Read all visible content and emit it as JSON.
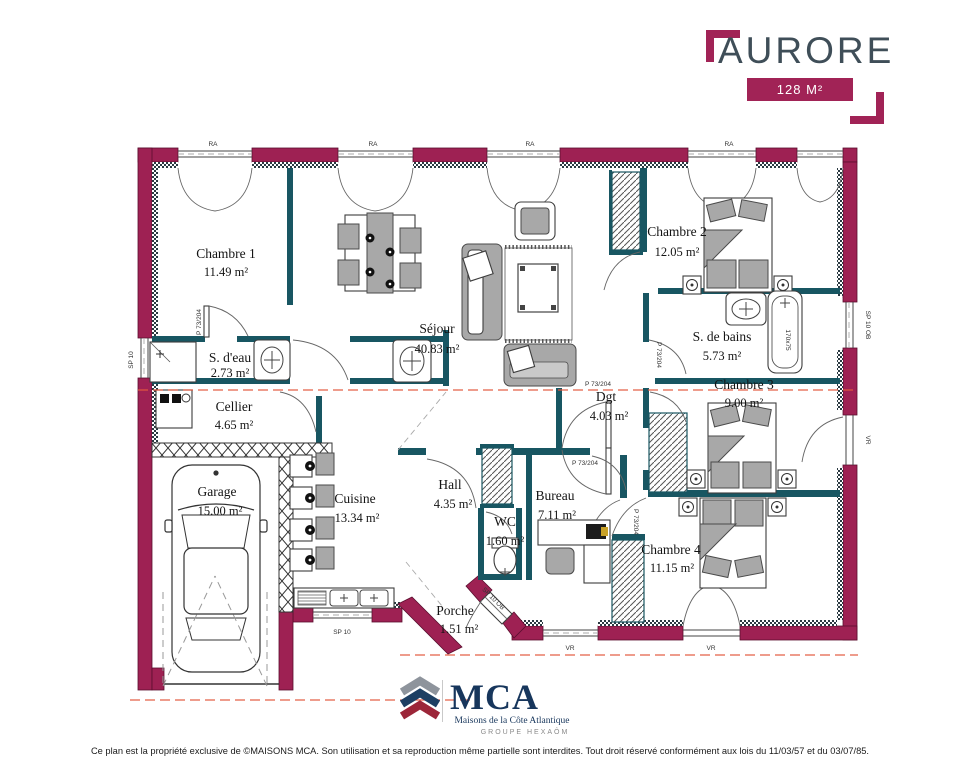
{
  "header": {
    "title": "AURORE",
    "area_badge": "128 M²"
  },
  "plan": {
    "rooms": [
      {
        "name": "Chambre 1",
        "area": "11.49 m²"
      },
      {
        "name": "Séjour",
        "area": "40.83 m²"
      },
      {
        "name": "Chambre 2",
        "area": "12.05 m²"
      },
      {
        "name": "S. de bains",
        "area": "5.73 m²"
      },
      {
        "name": "Chambre 3",
        "area": "9.00 m²"
      },
      {
        "name": "S. d'eau",
        "area": "2.73 m²"
      },
      {
        "name": "Cellier",
        "area": "4.65 m²"
      },
      {
        "name": "Dgt",
        "area": "4.03 m²"
      },
      {
        "name": "Garage",
        "area": "15.00 m²"
      },
      {
        "name": "Cuisine",
        "area": "13.34 m²"
      },
      {
        "name": "Hall",
        "area": "4.35 m²"
      },
      {
        "name": "WC",
        "area": "1.60 m²"
      },
      {
        "name": "Bureau",
        "area": "7.11 m²"
      },
      {
        "name": "Chambre 4",
        "area": "11.15 m²"
      },
      {
        "name": "Porche",
        "area": "1.51 m²"
      }
    ],
    "annotations": {
      "window_top": "RA",
      "shutter": "VR",
      "window_small": "SP 10",
      "entry_window": "SP 10 OB",
      "door": "P 73/204",
      "bath": "170x75"
    },
    "colors": {
      "wall_exterior": "#9e2153",
      "wall_interior": "#185662",
      "accent": "#a12356",
      "title": "#3f4e58",
      "section_line": "#e4573d"
    }
  },
  "footer": {
    "logo": "MCA",
    "subtitle": "Maisons de la Côte Atlantique",
    "group": "GROUPE HEXAÔM"
  },
  "copyright": "Ce plan est la propriété exclusive de ©MAISONS MCA. Son utilisation et sa reproduction même partielle sont interdites. Tout droit réservé conformément aux lois du 11/03/57 et du 03/07/85."
}
